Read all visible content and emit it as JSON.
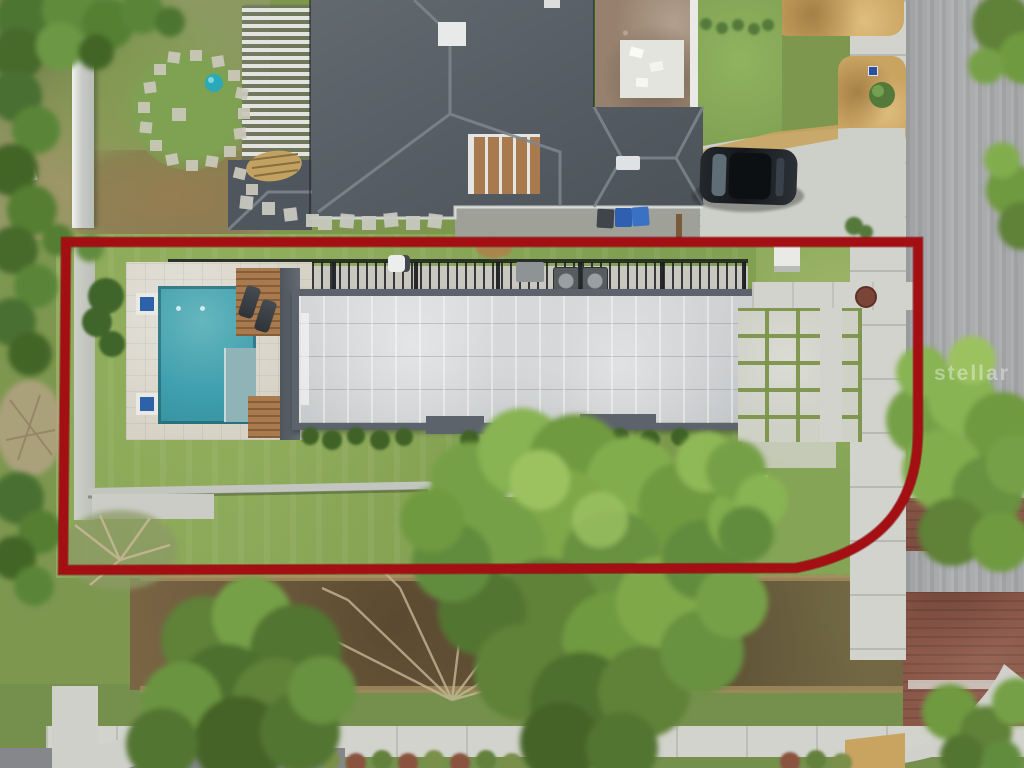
{
  "watermark": {
    "text": "stellar"
  },
  "colors": {
    "boundary": "#a30f13",
    "pool": "#3f9fae",
    "pool-shelf": "#8fb3b6",
    "roof-trim": "#5c636b",
    "neighbor-roof": "#596067",
    "lawn": "#7d974f",
    "lot-lawn": "#85a455",
    "wood": "#a87a4e",
    "concrete": "#d2d3cc",
    "asphalt": "#a7a9ab",
    "brick": "#8a5749",
    "dirt-road": "#715c3e",
    "mulch": "#c9a360",
    "tree-light": "#93bd58",
    "tree-mid": "#6f9a40",
    "tree-dark": "#527931",
    "watermark": "#ffffff"
  }
}
